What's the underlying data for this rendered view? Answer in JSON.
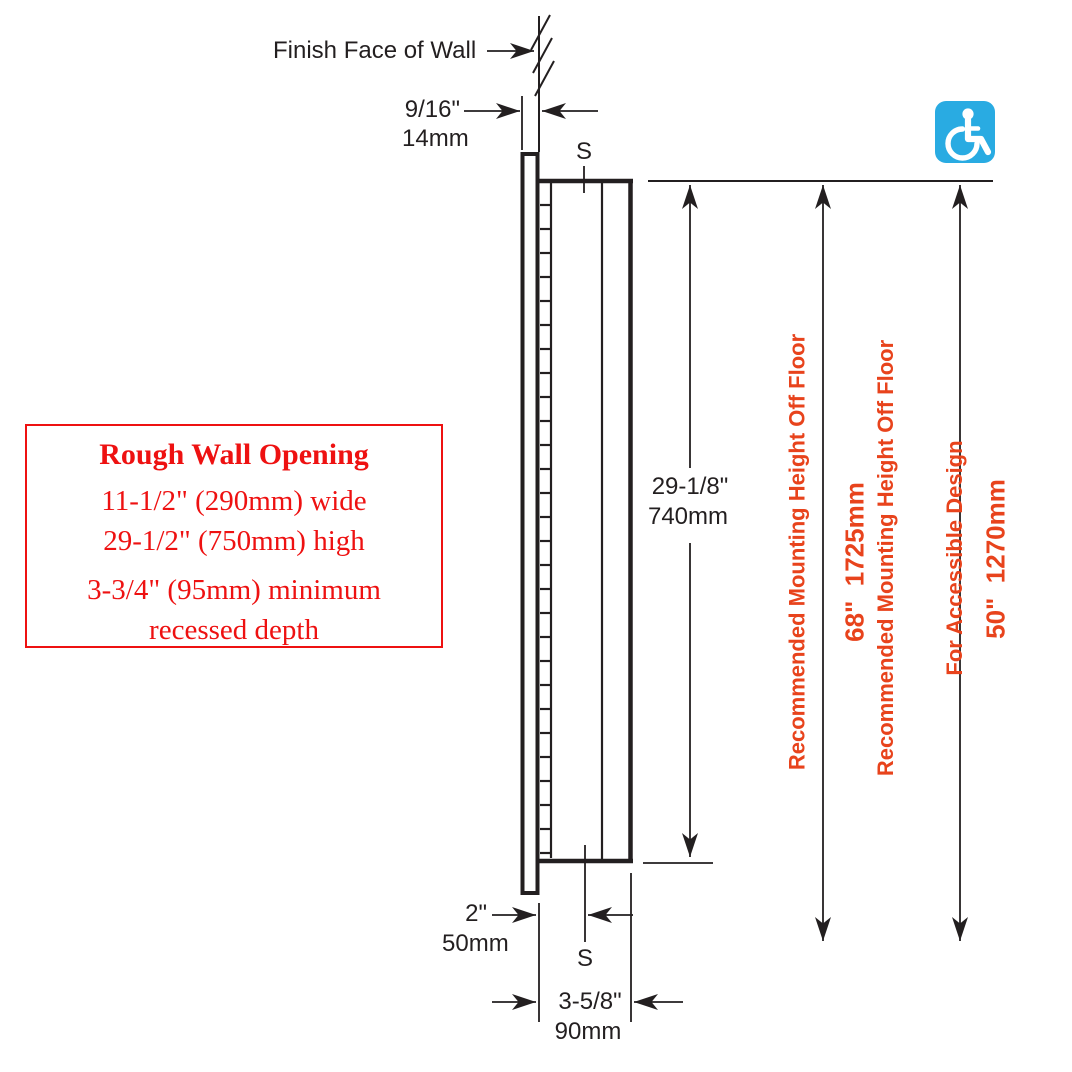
{
  "colors": {
    "black": "#231f20",
    "red": "#ee1111",
    "orange": "#e8431c",
    "icon_blue": "#29abe2",
    "white": "#ffffff"
  },
  "annotations": {
    "finish_face_of_wall": "Finish Face of Wall",
    "section_marker_top": "S",
    "section_marker_bottom": "S"
  },
  "dimensions": {
    "wall_offset": {
      "in": "9/16\"",
      "mm": "14mm"
    },
    "cabinet_height": {
      "in": "29-1/8\"",
      "mm": "740mm"
    },
    "flange_offset": {
      "in": "2\"",
      "mm": "50mm"
    },
    "cabinet_depth": {
      "in": "3-5/8\"",
      "mm": "90mm"
    }
  },
  "rough_wall_opening": {
    "title": "Rough Wall Opening",
    "width_line": "11-1/2\" (290mm) wide",
    "height_line": "29-1/2\" (750mm) high",
    "depth_line1": "3-3/4\" (95mm) minimum",
    "depth_line2": "recessed depth"
  },
  "mounting_heights": {
    "standard": {
      "label": "Recommended Mounting Height Off Floor",
      "value": "68\"  1725mm"
    },
    "accessible": {
      "label_line1": "Recommended Mounting Height Off Floor",
      "label_line2": "For Accessible Design",
      "value": "50\"  1270mm"
    }
  },
  "icons": {
    "accessibility": "wheelchair-accessibility-symbol"
  }
}
